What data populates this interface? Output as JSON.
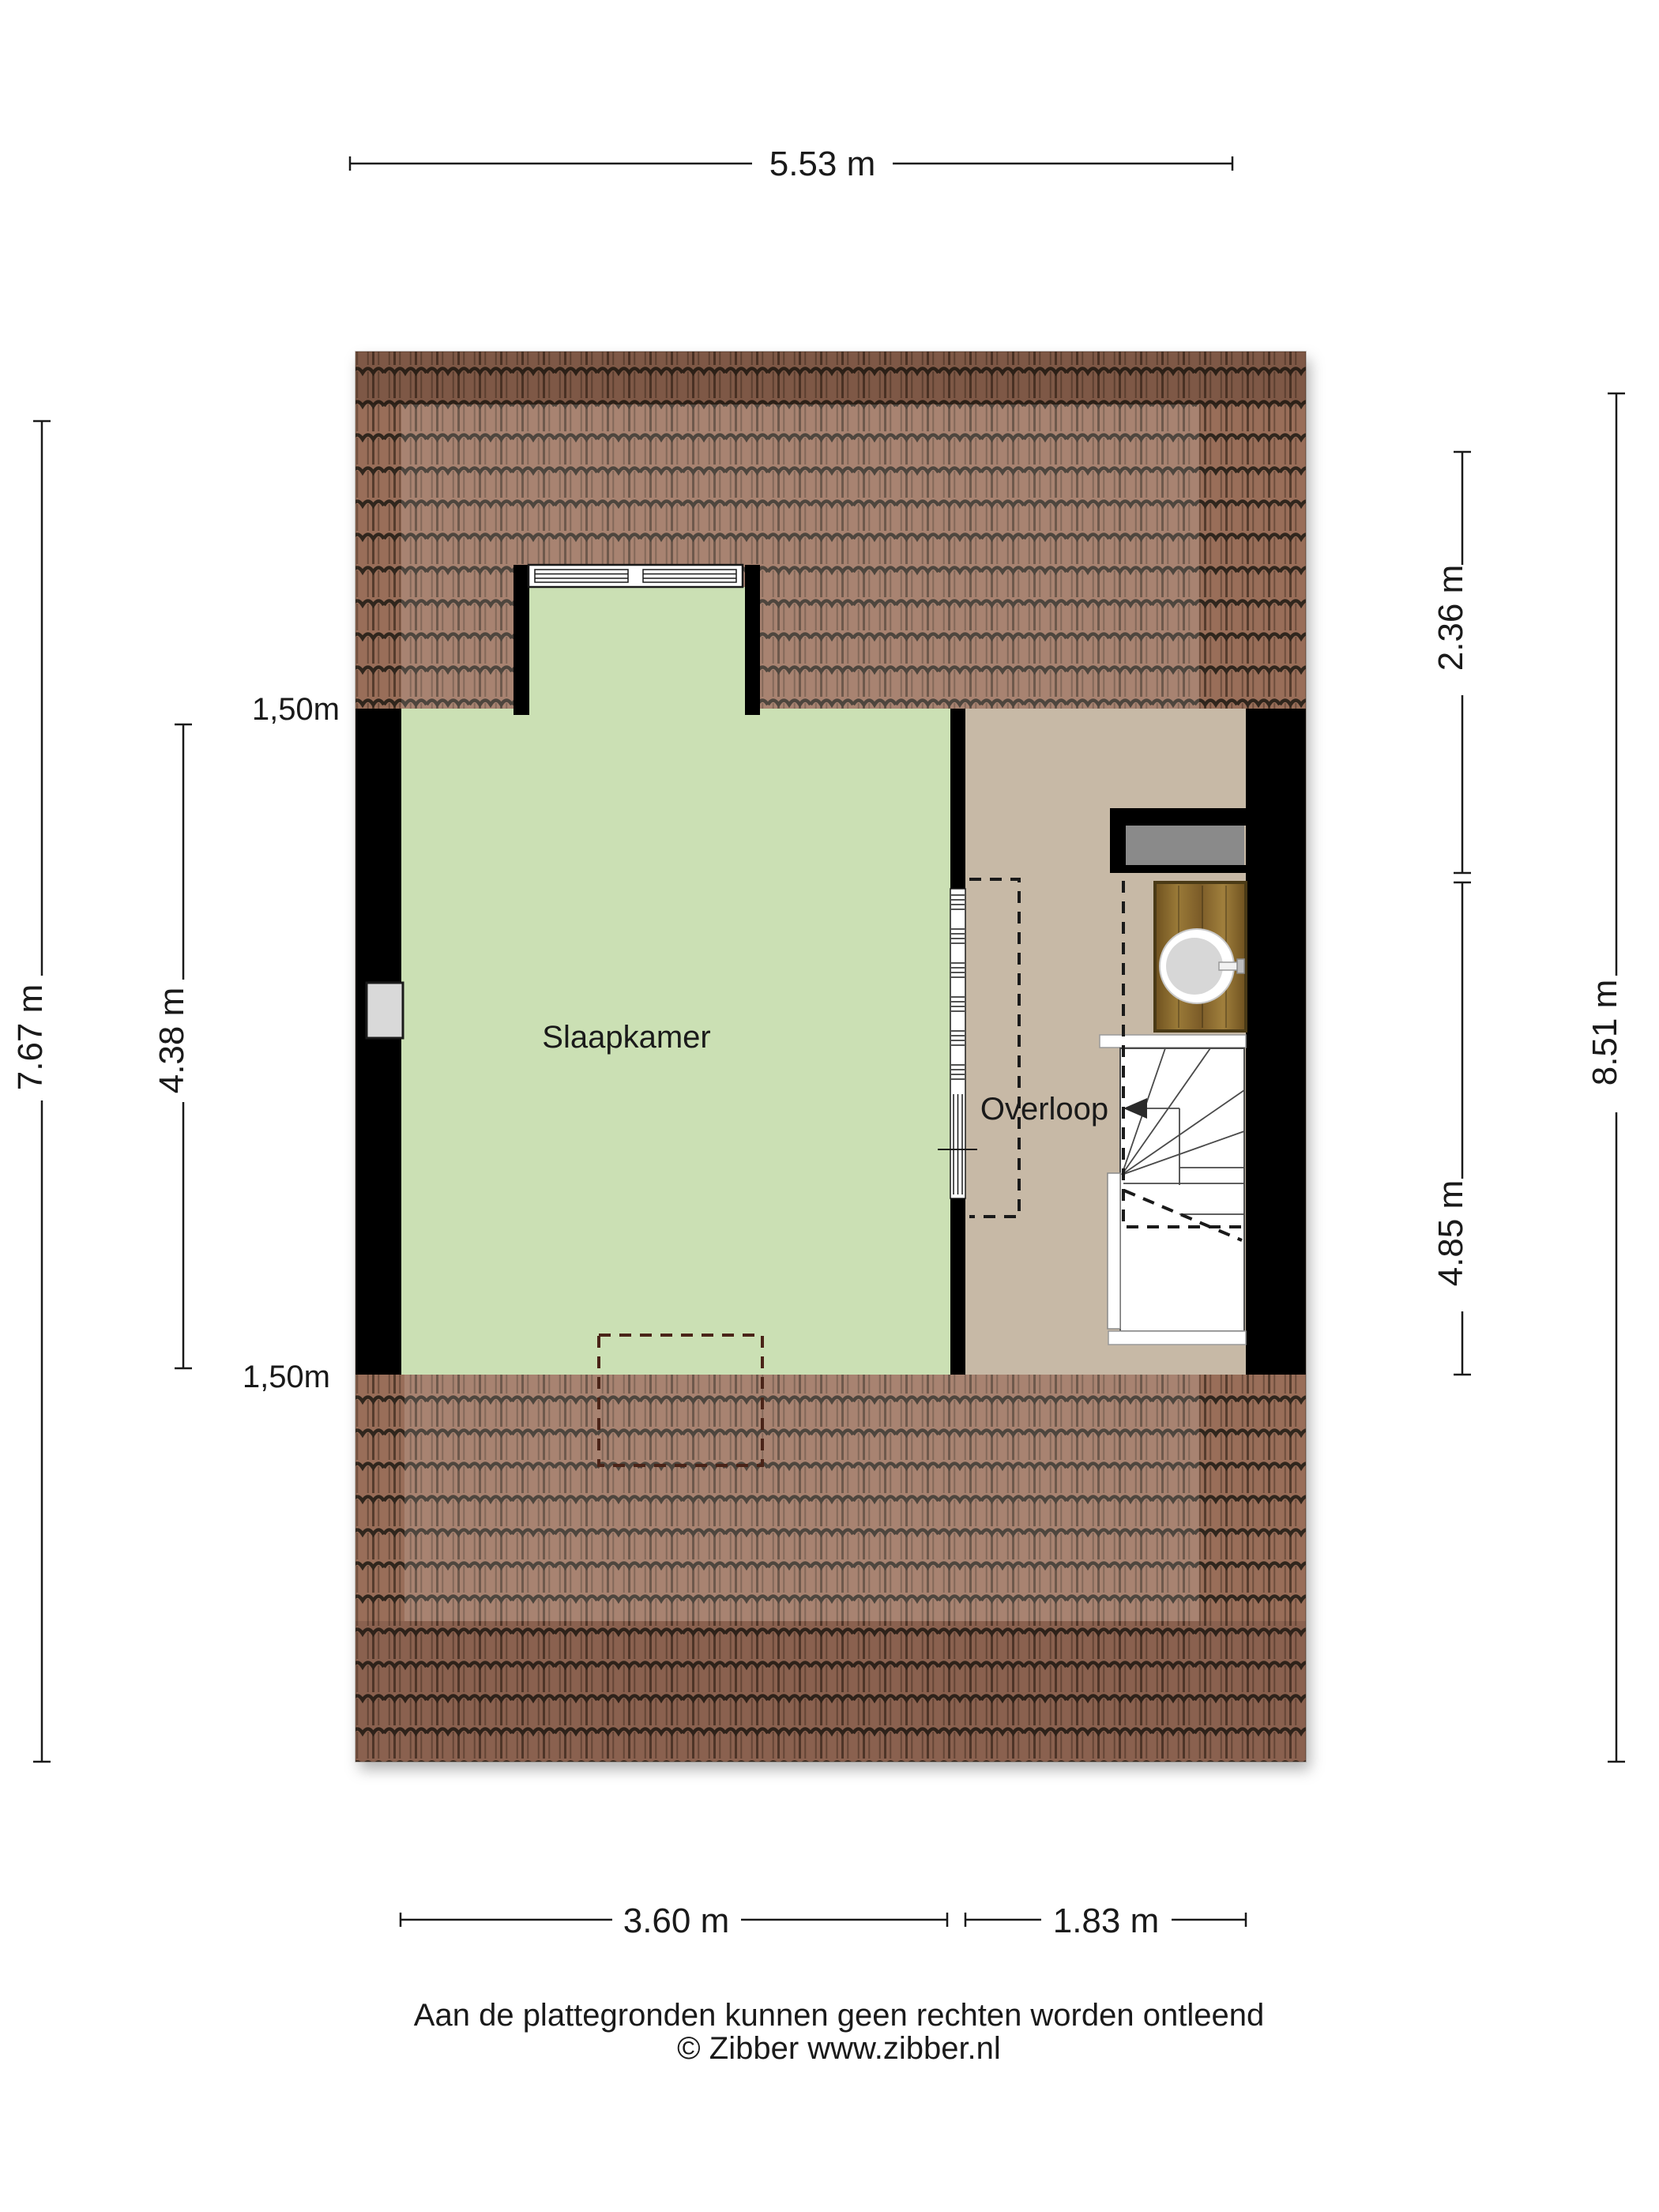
{
  "plan": {
    "type": "floorplan-attic-floor",
    "rooms": {
      "bedroom": "Slaapkamer",
      "landing": "Overloop"
    },
    "dimensions": {
      "top_width": "5.53 m",
      "left_outer_height": "7.67 m",
      "left_inner_height": "4.38 m",
      "right_top_height": "2.36 m",
      "right_inner_height": "4.85 m",
      "right_outer_height": "8.51 m",
      "bottom_left_width": "3.60 m",
      "bottom_right_width": "1.83 m",
      "ceiling_line_top": "1,50m",
      "ceiling_line_bottom": "1,50m"
    },
    "colors": {
      "bedroom_floor": "#cbe0b4",
      "landing_floor": "#c7b9a6",
      "walls": "#000000",
      "roof_tile_base": "#996e59",
      "roof_tile_line": "#30261d",
      "skylight_gray": "#8a8a8a",
      "cabinet_wood": "#8a6a2e",
      "dash_dark": "#1a1a1a",
      "dash_roof": "#4a2418"
    }
  },
  "footer": {
    "line1": "Aan de plattegronden kunnen geen rechten worden ontleend",
    "line2": "© Zibber www.zibber.nl"
  }
}
